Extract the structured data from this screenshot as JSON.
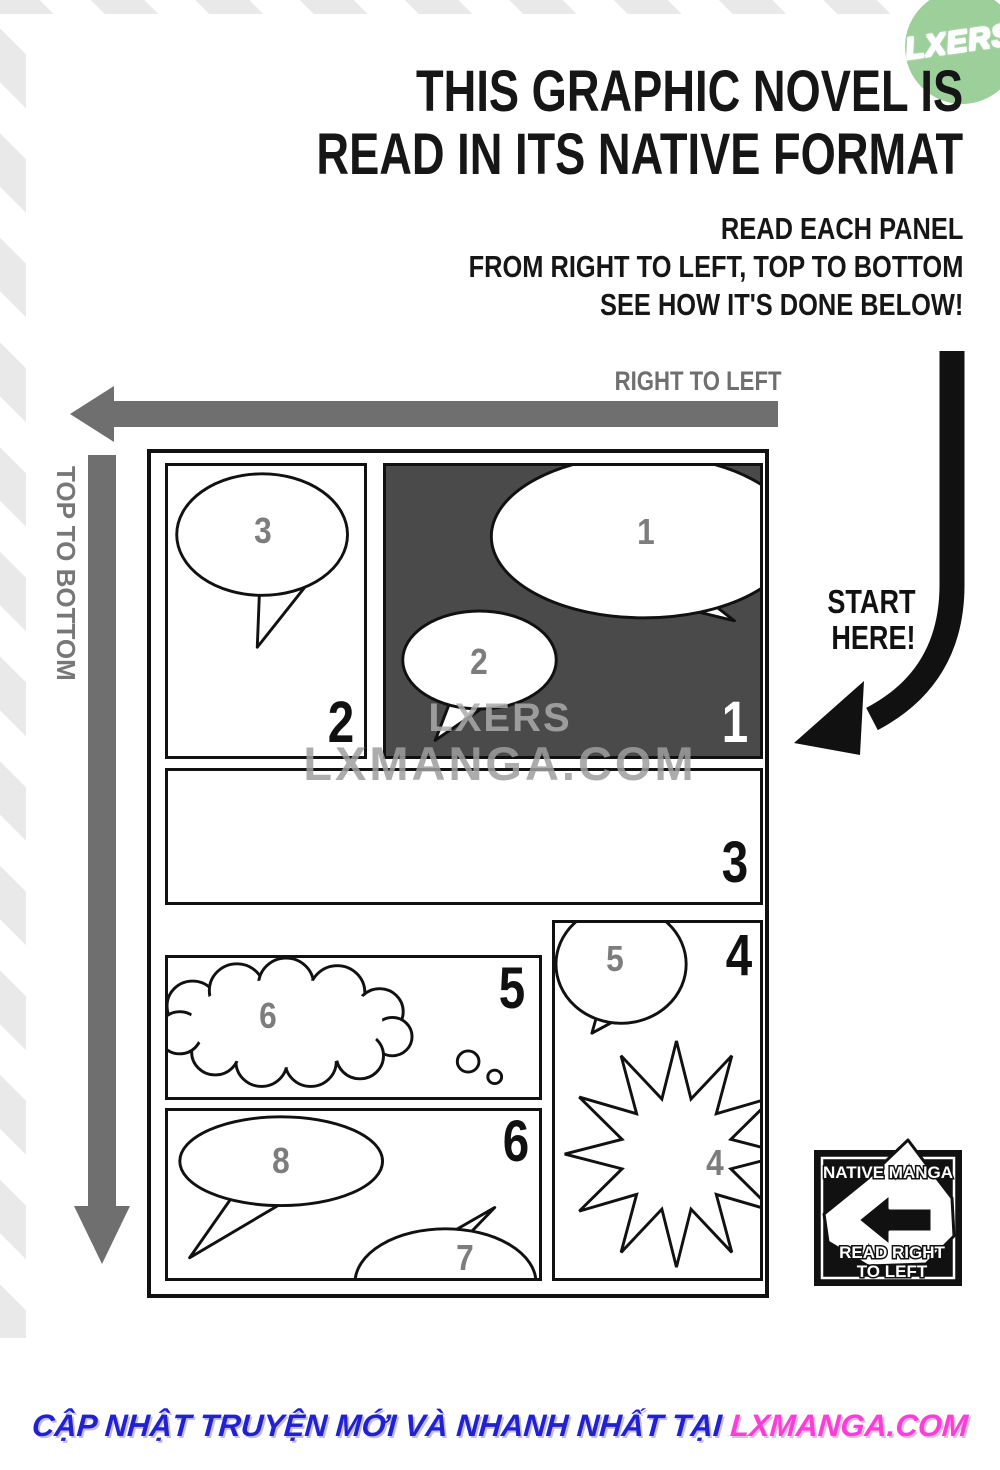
{
  "header": {
    "logo": "LXERS",
    "title_line1": "THIS GRAPHIC NOVEL IS",
    "title_line2": "READ IN ITS NATIVE FORMAT",
    "subtitle_lines": [
      "READ EACH PANEL",
      "FROM RIGHT TO LEFT, TOP TO BOTTOM",
      "SEE HOW IT'S DONE BELOW!"
    ]
  },
  "arrows": {
    "right_to_left_label": "RIGHT TO LEFT",
    "top_to_bottom_label": "TOP TO BOTTOM",
    "start_here_line1": "START",
    "start_here_line2": "HERE!"
  },
  "comic": {
    "panel_numbers": {
      "p1": "1",
      "p2": "2",
      "p3": "3",
      "p4": "4",
      "p5": "5",
      "p6": "6"
    },
    "bubbles": {
      "b1": "1",
      "b2": "2",
      "b3": "3",
      "b4": "4",
      "b5": "5",
      "b6": "6",
      "b7": "7",
      "b8": "8"
    }
  },
  "watermark": {
    "line1": "LXERS",
    "line2": "LXMANGA.COM"
  },
  "badge": {
    "top": "NATIVE MANGA",
    "bottom_line1": "READ RIGHT",
    "bottom_line2": "TO LEFT"
  },
  "footer": {
    "message": "CẬP NHẬT TRUYỆN MỚI VÀ NHANH NHẤT TẠI",
    "site": "LXMANGA.COM"
  },
  "colors": {
    "panel_dark": "#4a4a4a",
    "arrow_gray": "#6f6f6f",
    "logo_green": "#9ccf9a",
    "footer_blue": "#2121d3",
    "footer_pink": "#fb3ed8"
  }
}
